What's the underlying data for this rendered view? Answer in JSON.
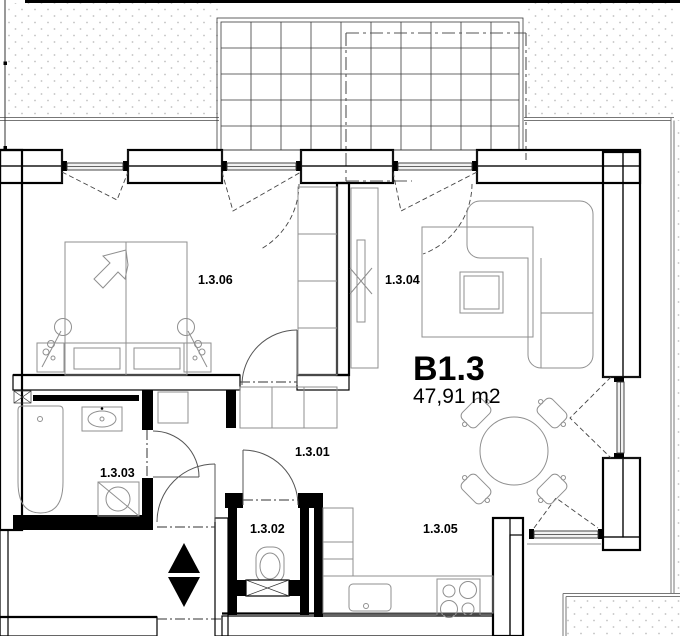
{
  "unit": {
    "code": "B1.3",
    "area": "47,91 m2"
  },
  "rooms": {
    "hall": "1.3.01",
    "wc": "1.3.02",
    "bath": "1.3.03",
    "living": "1.3.04",
    "kitchen": "1.3.05",
    "bedroom": "1.3.06"
  },
  "colors": {
    "ink": "#000000",
    "furn": "#8f8f8f",
    "hatch": "#8a8a8a",
    "stipple": "#c2c2c2",
    "dash": "#444444",
    "paper": "#ffffff"
  }
}
